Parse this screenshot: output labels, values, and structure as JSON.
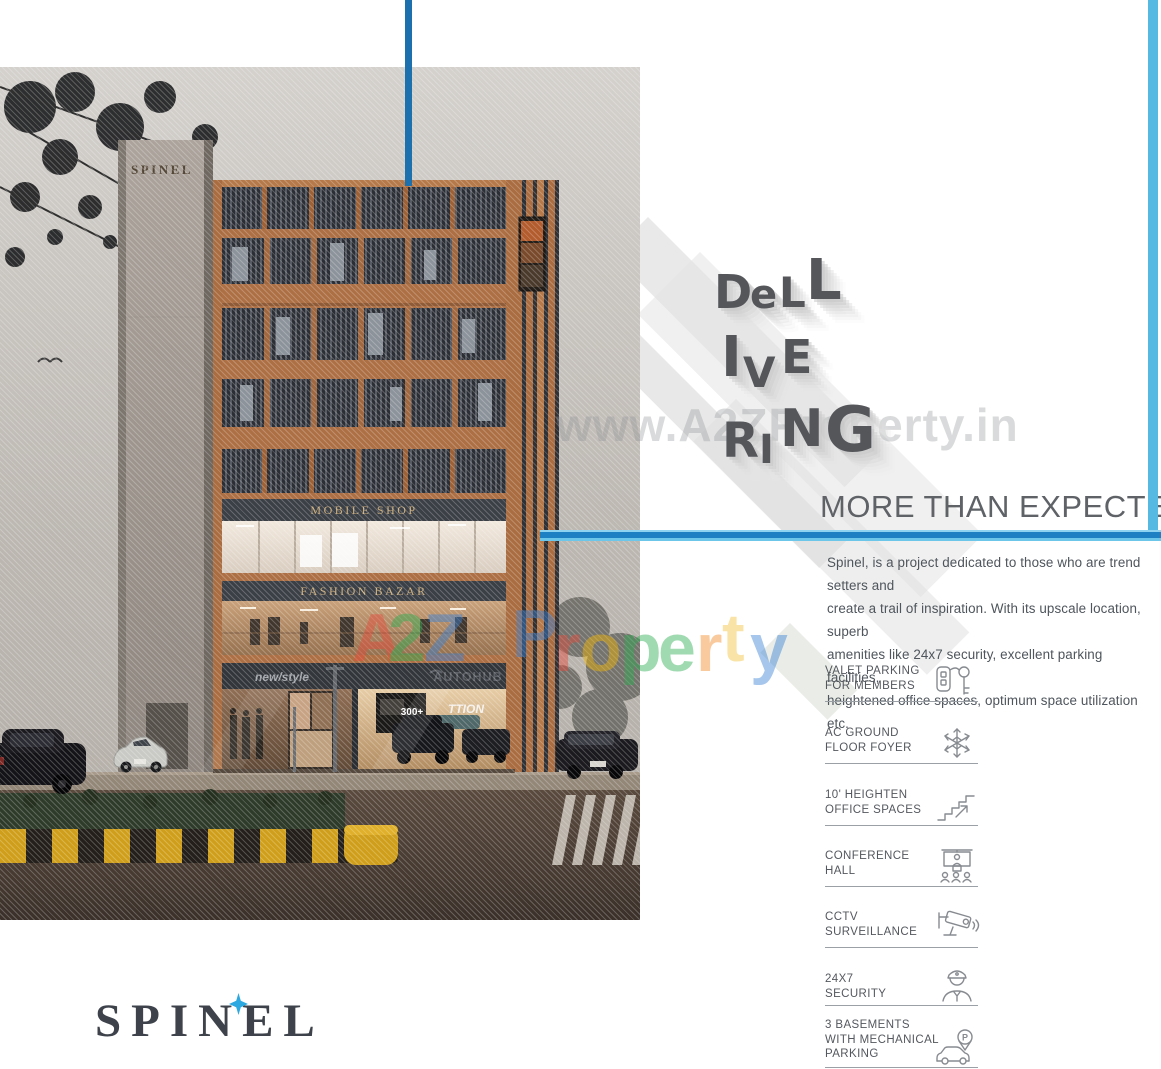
{
  "branding": {
    "logo_text": "SPINEL",
    "tower_sign_text": "SPINEL"
  },
  "headline": {
    "word": "DELIVERING",
    "letters": [
      "D",
      "e",
      "L",
      "L",
      "I",
      "V",
      "E",
      "R",
      "I",
      "N",
      "G"
    ],
    "tagline": "MORE THAN EXPECTED"
  },
  "watermark": {
    "url_text": "www.A2ZProperty.in",
    "brand_text": "A2Z Property",
    "brand_letters": [
      "A",
      "2",
      "Z",
      "P",
      "r",
      "o",
      "p",
      "e",
      "r",
      "t",
      "y"
    ]
  },
  "description": "Spinel, is a project dedicated to those who are trend setters and\ncreate a trail of inspiration. With its upscale location, superb\namenities like 24x7 security, excellent parking facilities,\nheightened office spaces, optimum space utilization etc.",
  "amenities": [
    {
      "label": "VALET PARKING\nFOR MEMBERS",
      "icon": "car-key-icon"
    },
    {
      "label": "AC GROUND\nFLOOR FOYER",
      "icon": "snowflake-icon"
    },
    {
      "label": "10' HEIGHTEN\nOFFICE SPACES",
      "icon": "stairs-icon"
    },
    {
      "label": "CONFERENCE\nHALL",
      "icon": "conference-hall-icon"
    },
    {
      "label": "CCTV\nSURVEILLANCE",
      "icon": "cctv-camera-icon"
    },
    {
      "label": "24X7\nSECURITY",
      "icon": "security-guard-icon"
    },
    {
      "label": "3 BASEMENTS\nWITH MECHANICAL\nPARKING",
      "icon": "mechanical-parking-icon"
    }
  ],
  "building": {
    "signs": {
      "mobile_shop": "MOBILE SHOP",
      "fashion_bazar": "FASHION BAZAR",
      "new_style": "new/style",
      "autohub": "AUTOHUB",
      "showroom_poster": "300+",
      "showroom_banner": "TTION"
    }
  },
  "colors": {
    "accent_blue_dark": "#1c70ad",
    "accent_blue_light": "#55b9e2",
    "headline_gray": "#54565a",
    "logo_star_blue": "#2ca9e1"
  }
}
